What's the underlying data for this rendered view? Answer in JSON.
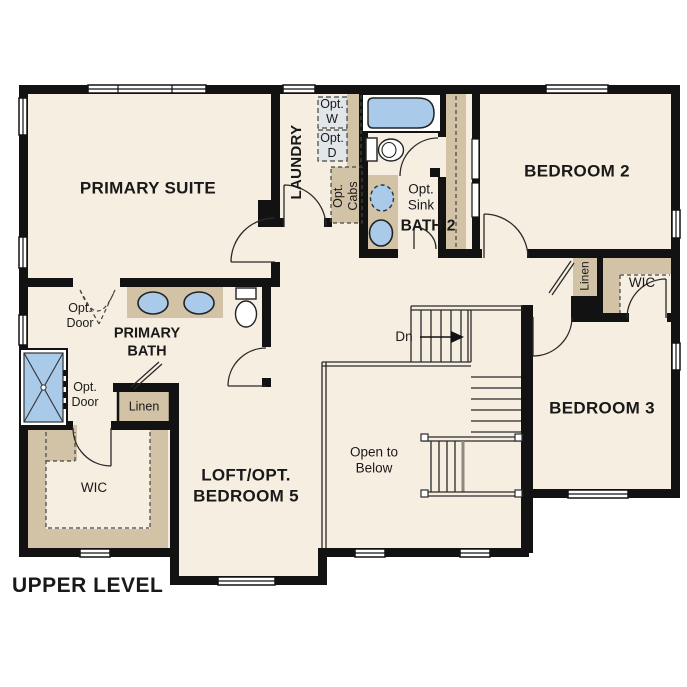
{
  "level_label": "UPPER LEVEL",
  "rooms": {
    "primary_suite": "PRIMARY SUITE",
    "laundry": "LAUNDRY",
    "bath_2": "BATH 2",
    "bedroom_2": "BEDROOM 2",
    "bedroom_3": "BEDROOM 3",
    "loft": "LOFT/OPT. BEDROOM 5",
    "primary_bath": "PRIMARY BATH",
    "wic_left": "WIC",
    "wic_right": "WIC",
    "linen_hall": "Linen",
    "linen_primary": "Linen",
    "open_to_below": "Open to Below"
  },
  "annotations": {
    "opt_washer": "Opt. W",
    "opt_dryer": "Opt. D",
    "opt_cabs": "Opt. Cabs",
    "opt_sink": "Opt. Sink",
    "opt_door_upper": "Opt. Door",
    "opt_door_lower": "Opt. Door",
    "stair_down": "Dn"
  },
  "colors": {
    "floor": "#f6eee1",
    "wall": "#121212",
    "cabinet": "#d2c3a7",
    "fixture_blue": "#a9cae8",
    "appliance_box": "#e2e6e9"
  }
}
